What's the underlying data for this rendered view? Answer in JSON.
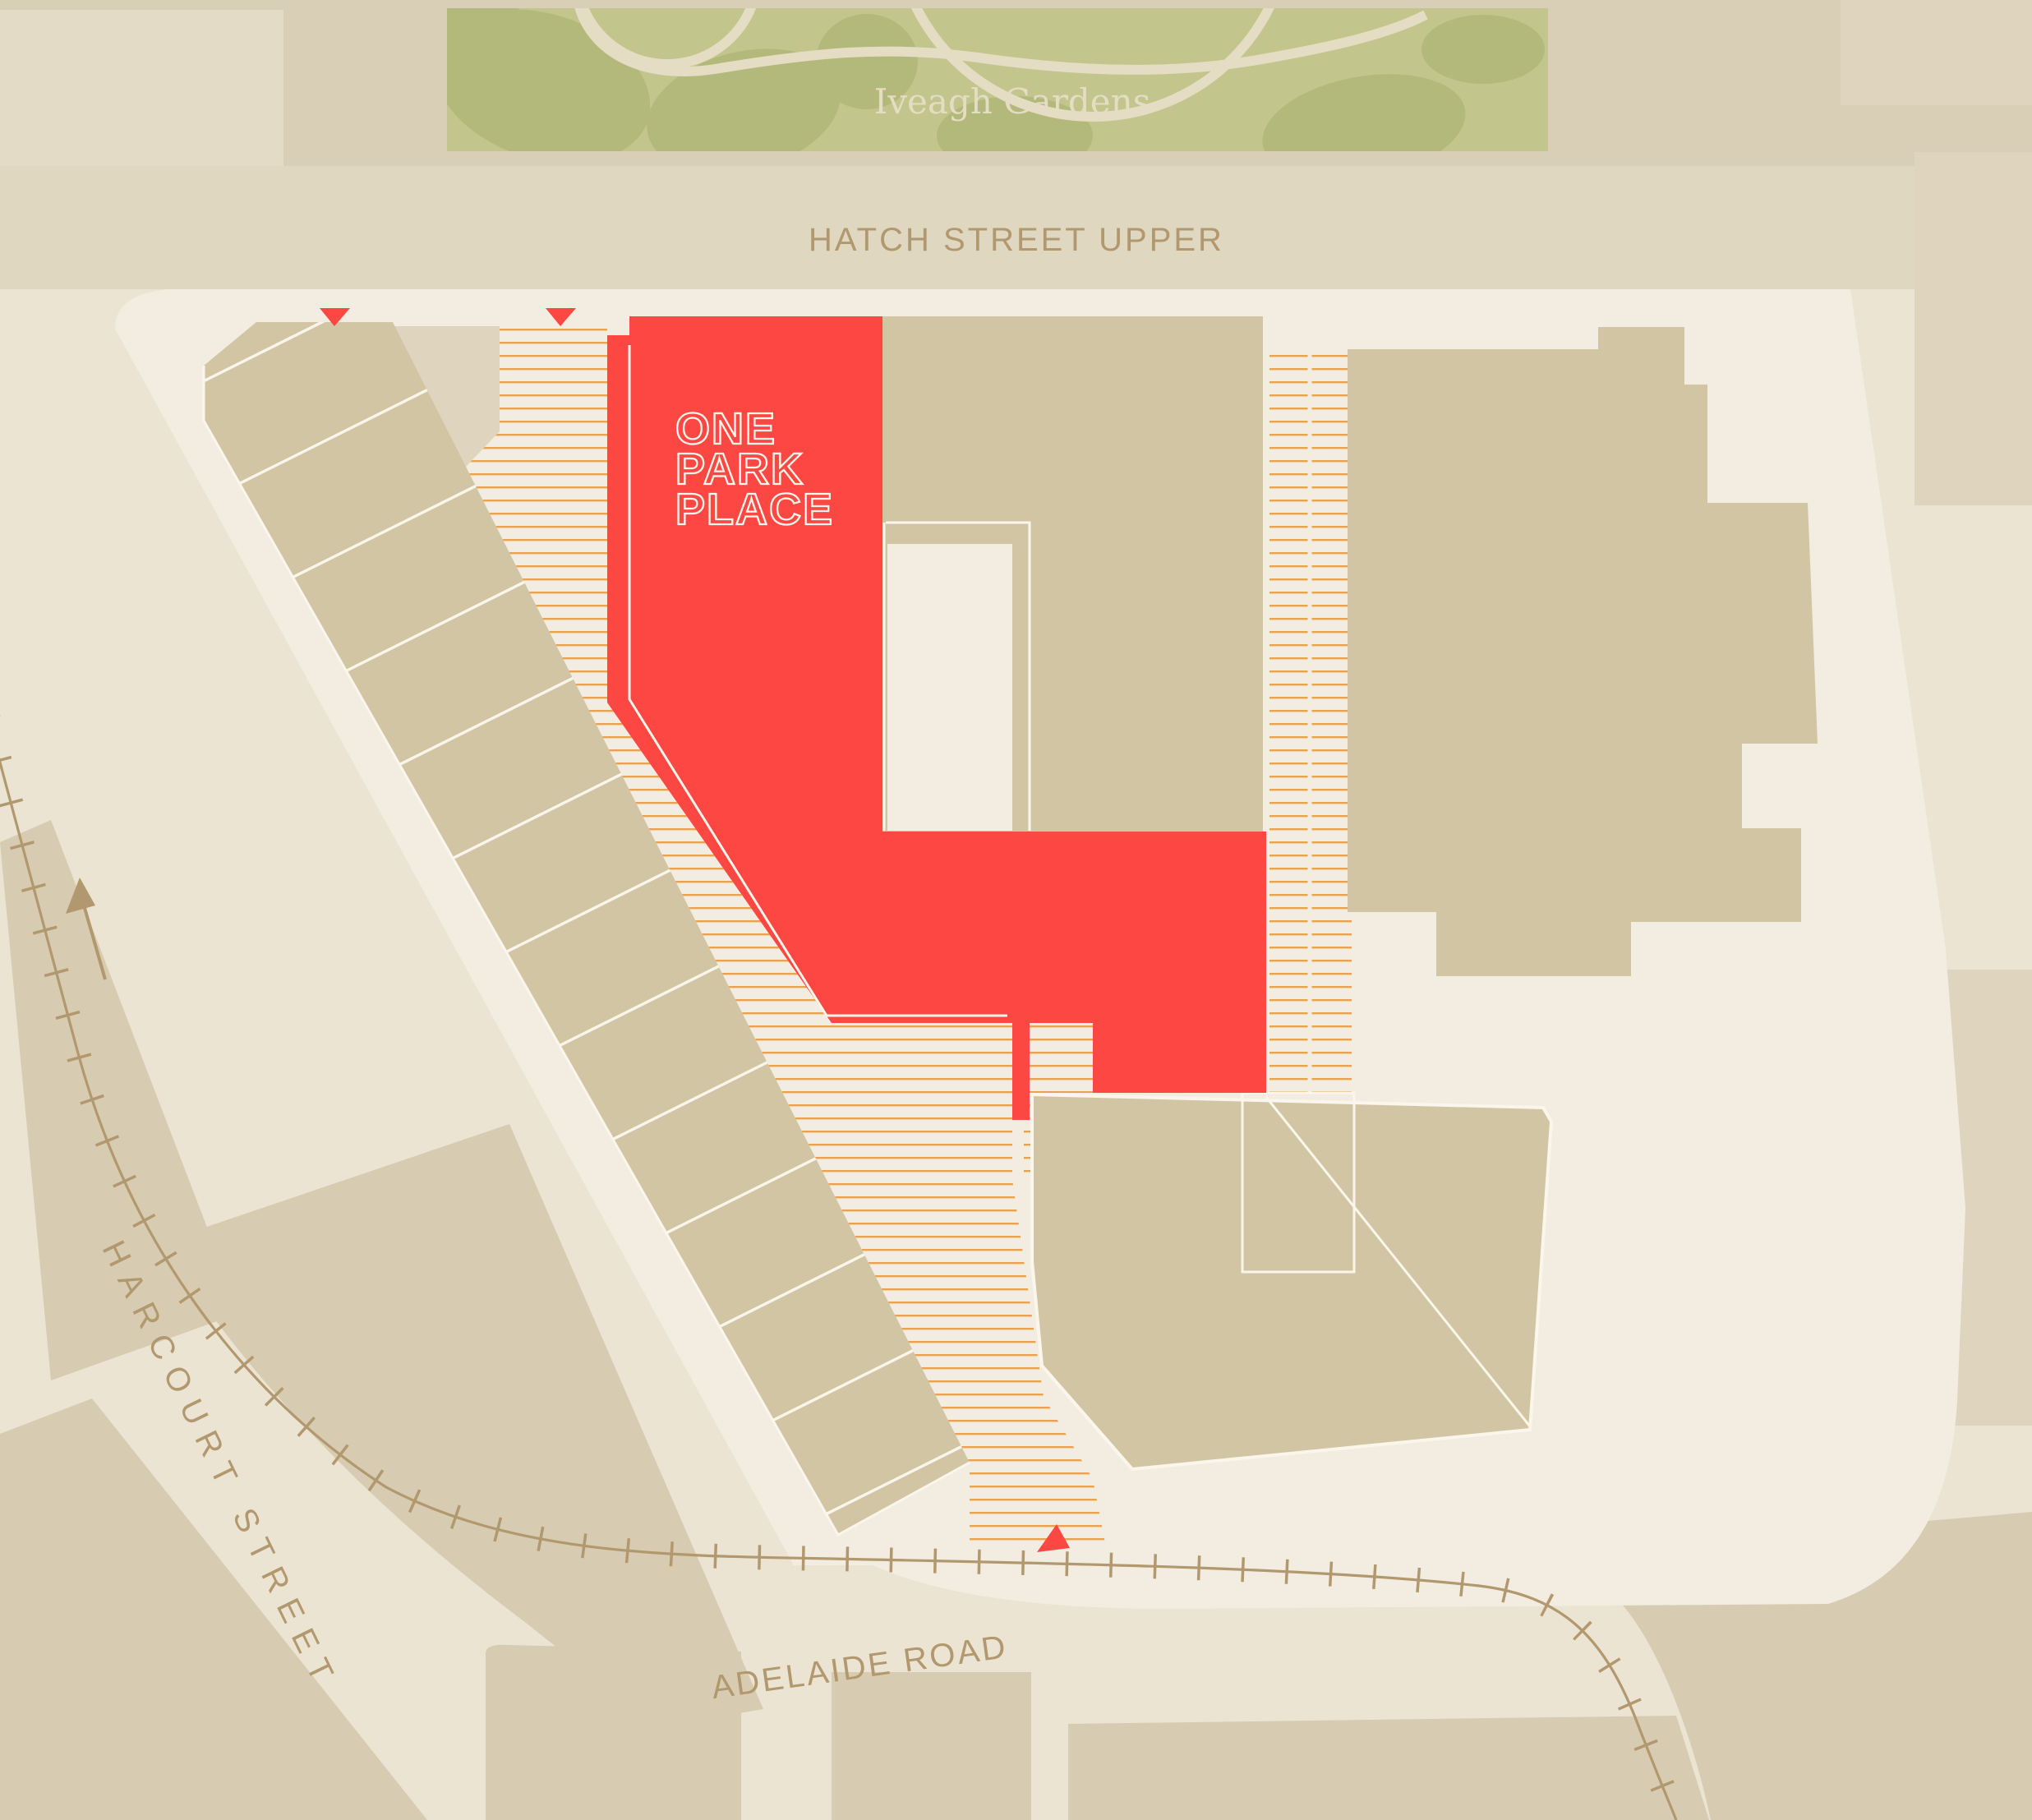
{
  "map": {
    "title": "One Park Place site location map",
    "park_label": "Iveagh Gardens",
    "streets": {
      "top": "HATCH STREET UPPER",
      "left": "HARCOURT STREET",
      "bottom": "ADELAIDE ROAD"
    },
    "highlight_building": {
      "name": "One Park Place",
      "label_line1": "ONE",
      "label_line2": "PARK",
      "label_line3": "PLACE"
    },
    "markers": {
      "entrance_triangles_count": 3,
      "one_way_arrow": "harcourt-street-northbound"
    }
  },
  "theme": {
    "bg_tan": "#D9CFB7",
    "panel_cream": "#E4DBC6",
    "band_cream": "#E0D7C1",
    "road_cream": "#EBE4D2",
    "site_cream": "#F2EDE0",
    "green_base": "#C2C68D",
    "green_blob": "#B2B97A",
    "path_cream": "#E4DCC3",
    "building_tan": "#D2C5A4",
    "parcel_tan": "#D7CBB1",
    "parcel_tan2": "#DFD5BF",
    "red": "#FC4742",
    "hatch_orange": "#E8A351",
    "text_brown": "#B2986E",
    "white_line": "#FAF6EC"
  }
}
